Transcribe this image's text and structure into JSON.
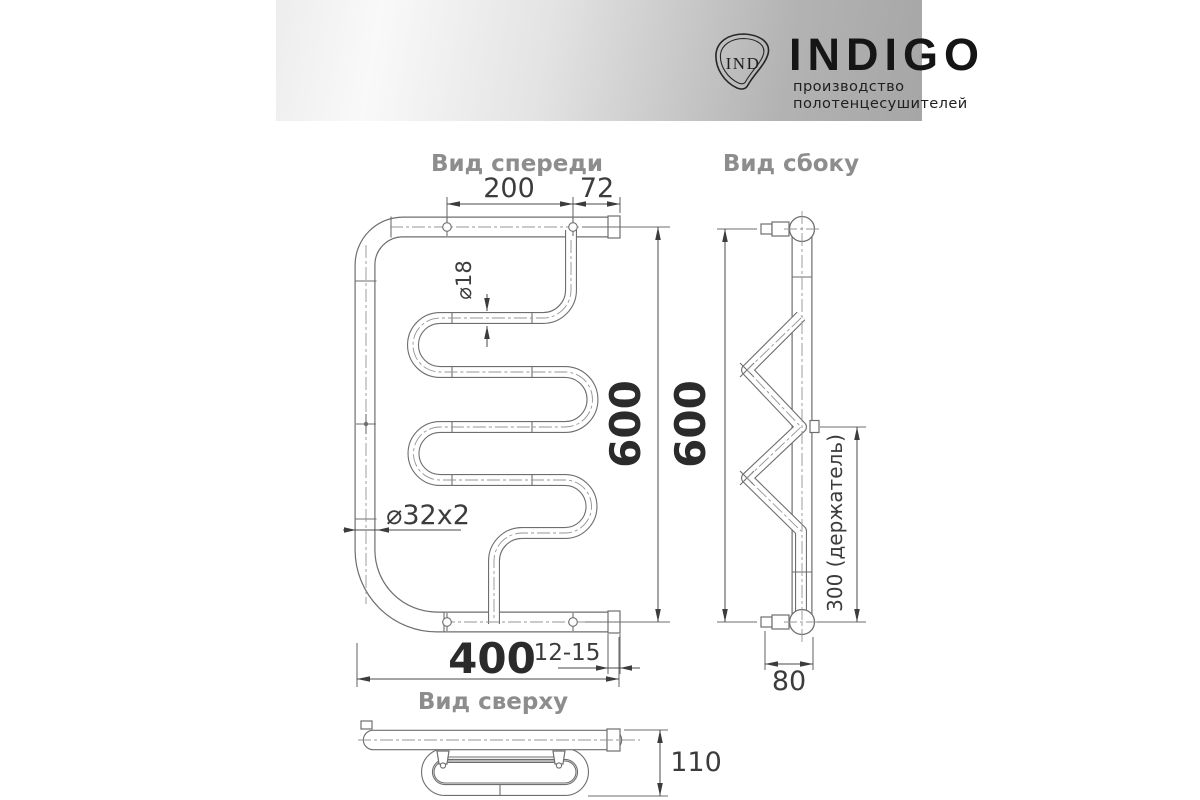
{
  "header": {
    "logo_monogram": "IND",
    "brand": "INDIGO",
    "tagline": "производство полотенцесушителей"
  },
  "views": {
    "front": {
      "title": "Вид спереди",
      "dims": {
        "bracket_span": "200",
        "end_offset": "72",
        "coil_tube_diameter": "⌀18",
        "height": "600",
        "frame_tube": "⌀32x2",
        "width": "400",
        "wall_gap": "12-15"
      }
    },
    "side": {
      "title": "Вид сбоку",
      "dims": {
        "height": "600",
        "holder_offset": "300 (держатель)",
        "bottom_depth": "80"
      }
    },
    "top": {
      "title": "Вид сверху",
      "dims": {
        "depth": "110"
      }
    }
  },
  "colors": {
    "drawing_line": "#6e6e6e",
    "dim_text": "#3c3c3c",
    "dim_text_strong": "#2b2b2b",
    "view_title": "#8d8d8d",
    "banner_light": "#f5f5f5",
    "banner_dark": "#a6a6a6",
    "brand_ink": "#151515"
  }
}
